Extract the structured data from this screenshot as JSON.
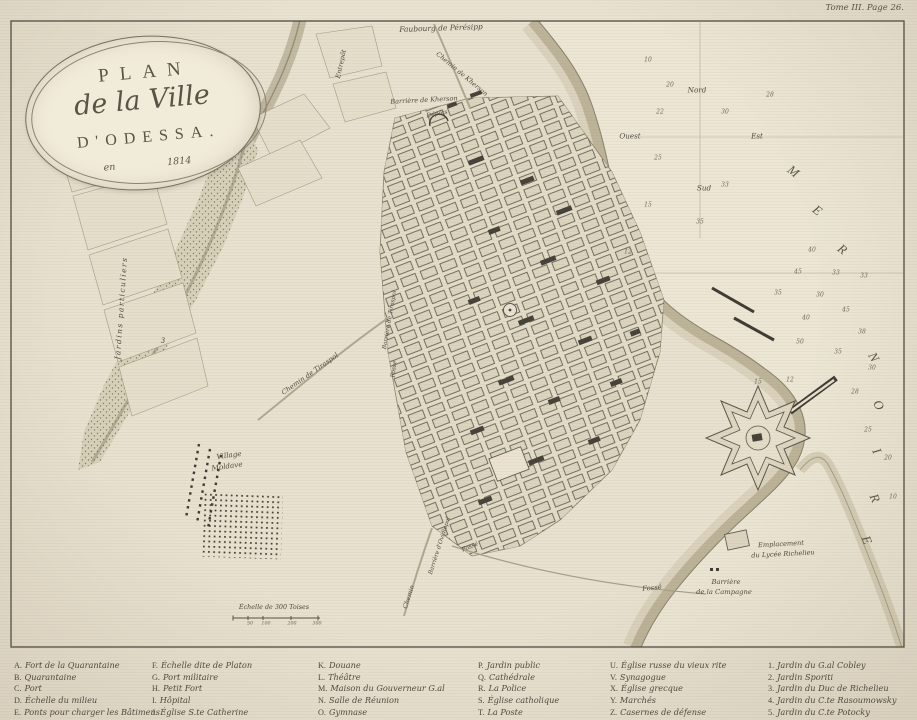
{
  "page": {
    "corner_note": "Tome III. Page 26."
  },
  "cartouche": {
    "top": "PLAN",
    "middle": "de la Ville",
    "bottom": "D'ODESSA.",
    "year_left": "en",
    "year_right": "1814"
  },
  "colors": {
    "paper": "#e9e2d1",
    "ink": "#4f4b40",
    "sea": "#ece6d5"
  },
  "legend": {
    "col_x": [
      14,
      152,
      318,
      478,
      610,
      768
    ],
    "columns": [
      [
        {
          "k": "A.",
          "t": "Fort de la Quarantaine"
        },
        {
          "k": "B.",
          "t": "Quarantaine"
        },
        {
          "k": "C.",
          "t": "Port"
        },
        {
          "k": "D.",
          "t": "Échelle du milieu"
        },
        {
          "k": "E.",
          "t": "Ponts pour charger les Bâtimens"
        }
      ],
      [
        {
          "k": "F.",
          "t": "Échelle dite de Platon"
        },
        {
          "k": "G.",
          "t": "Port militaire"
        },
        {
          "k": "H.",
          "t": "Petit Fort"
        },
        {
          "k": "I.",
          "t": "Hôpital"
        },
        {
          "k": "J.",
          "t": "Église S.te Catherine"
        }
      ],
      [
        {
          "k": "K.",
          "t": "Douane"
        },
        {
          "k": "L.",
          "t": "Théâtre"
        },
        {
          "k": "M.",
          "t": "Maison du Gouverneur G.al"
        },
        {
          "k": "N.",
          "t": "Salle de Réunion"
        },
        {
          "k": "O.",
          "t": "Gymnase"
        }
      ],
      [
        {
          "k": "P.",
          "t": "Jardin public"
        },
        {
          "k": "Q.",
          "t": "Cathédrale"
        },
        {
          "k": "R.",
          "t": "La Police"
        },
        {
          "k": "S.",
          "t": "Église catholique"
        },
        {
          "k": "T.",
          "t": "La Poste"
        }
      ],
      [
        {
          "k": "U.",
          "t": "Église russe du vieux rite"
        },
        {
          "k": "V.",
          "t": "Synagogue"
        },
        {
          "k": "X.",
          "t": "Église grecque"
        },
        {
          "k": "Y.",
          "t": "Marchés"
        },
        {
          "k": "Z.",
          "t": "Casernes de défense"
        }
      ],
      [
        {
          "k": "1.",
          "t": "Jardin du G.al Cobley"
        },
        {
          "k": "2.",
          "t": "Jardin Sporiti"
        },
        {
          "k": "3.",
          "t": "Jardin du Duc de Richelieu"
        },
        {
          "k": "4.",
          "t": "Jardin du C.te Rasoumowsky"
        },
        {
          "k": "5.",
          "t": "Jardin du C.te Potocky"
        }
      ]
    ]
  },
  "map_labels": [
    {
      "t": "Faubourg de Pérésipp",
      "x": 441,
      "y": 28,
      "r": -2,
      "s": 7.5,
      "name": "label-faubourg-peresipp"
    },
    {
      "t": "Chemin de Kherson",
      "x": 462,
      "y": 74,
      "r": 40,
      "s": 6.5,
      "name": "label-chemin-de-kherson"
    },
    {
      "t": "Barrière de Kherson",
      "x": 424,
      "y": 100,
      "r": -3,
      "s": 6.5,
      "name": "label-barriere-de-kherson"
    },
    {
      "t": "Dépôts",
      "x": 437,
      "y": 114,
      "r": -10,
      "s": 6,
      "name": "label-depots"
    },
    {
      "t": "Entrepôt",
      "x": 341,
      "y": 64,
      "r": -78,
      "s": 6.5,
      "name": "label-entrepot"
    },
    {
      "t": "Jardins particuliers",
      "x": 121,
      "y": 308,
      "r": -86,
      "s": 7.5,
      "ls": 1.5,
      "name": "label-jardins-particuliers"
    },
    {
      "t": "3",
      "x": 163,
      "y": 341,
      "r": 0,
      "s": 7,
      "name": "label-garden-3"
    },
    {
      "t": "Chemin de Tiraspol",
      "x": 310,
      "y": 374,
      "r": -35,
      "s": 6.8,
      "name": "label-chemin-de-tiraspol"
    },
    {
      "t": "Barrière de Tiraspol",
      "x": 390,
      "y": 320,
      "r": -80,
      "s": 5.8,
      "name": "label-barriere-de-tiraspol"
    },
    {
      "t": "Fossé",
      "x": 394,
      "y": 369,
      "r": -84,
      "s": 6,
      "name": "label-fosse-west"
    },
    {
      "t": "Village",
      "x": 229,
      "y": 455,
      "r": -8,
      "s": 7.2,
      "name": "label-village"
    },
    {
      "t": "Moldave",
      "x": 227,
      "y": 466,
      "r": -8,
      "s": 7.2,
      "name": "label-moldave"
    },
    {
      "t": "Barrière d'Ovidiopol",
      "x": 440,
      "y": 546,
      "r": -72,
      "s": 5.8,
      "name": "label-barriere-ovidiopol"
    },
    {
      "t": "Chemin",
      "x": 409,
      "y": 597,
      "r": -72,
      "s": 6.2,
      "name": "label-chemin-ovidiopol"
    },
    {
      "t": "Fossé",
      "x": 470,
      "y": 547,
      "r": -22,
      "s": 6,
      "name": "label-fosse-south"
    },
    {
      "t": "Fossé",
      "x": 652,
      "y": 588,
      "r": -6,
      "s": 6.8,
      "name": "label-fosse-east"
    },
    {
      "t": "Barrière",
      "x": 726,
      "y": 582,
      "r": 0,
      "s": 6.8,
      "name": "label-barriere-campagne-line1"
    },
    {
      "t": "de la Campagne",
      "x": 724,
      "y": 592,
      "r": 0,
      "s": 6.8,
      "name": "label-barriere-campagne-line2"
    },
    {
      "t": "Emplacement",
      "x": 781,
      "y": 544,
      "r": -3,
      "s": 6.6,
      "name": "label-emplacement"
    },
    {
      "t": "du Lycée Richelieu",
      "x": 783,
      "y": 554,
      "r": -3,
      "s": 6.6,
      "name": "label-lycee-richelieu"
    },
    {
      "t": "Échelle de 300 Toises",
      "x": 274,
      "y": 607,
      "r": 0,
      "s": 6.4,
      "name": "label-scale-bar"
    },
    {
      "t": "50",
      "x": 250,
      "y": 624,
      "r": 0,
      "s": 4.8,
      "cls": "snd",
      "name": "scale-tick"
    },
    {
      "t": "100",
      "x": 266,
      "y": 624,
      "r": 0,
      "s": 4.8,
      "cls": "snd",
      "name": "scale-tick"
    },
    {
      "t": "200",
      "x": 292,
      "y": 624,
      "r": 0,
      "s": 4.8,
      "cls": "snd",
      "name": "scale-tick"
    },
    {
      "t": "300",
      "x": 317,
      "y": 624,
      "r": 0,
      "s": 4.8,
      "cls": "snd",
      "name": "scale-tick"
    },
    {
      "t": "Nord",
      "x": 697,
      "y": 90,
      "r": 0,
      "s": 7.2,
      "name": "compass-north"
    },
    {
      "t": "Ouest",
      "x": 630,
      "y": 136,
      "r": 0,
      "s": 7.2,
      "name": "compass-west"
    },
    {
      "t": "Est",
      "x": 757,
      "y": 136,
      "r": 0,
      "s": 7.2,
      "name": "compass-east"
    },
    {
      "t": "Sud",
      "x": 704,
      "y": 188,
      "r": 0,
      "s": 7.2,
      "name": "compass-south"
    },
    {
      "t": "M",
      "x": 794,
      "y": 172,
      "r": 38,
      "s": 13,
      "cls": "sea",
      "name": "sea-name-letter"
    },
    {
      "t": "E",
      "x": 818,
      "y": 211,
      "r": 38,
      "s": 13,
      "cls": "sea",
      "name": "sea-name-letter"
    },
    {
      "t": "R",
      "x": 843,
      "y": 250,
      "r": 38,
      "s": 13,
      "cls": "sea",
      "name": "sea-name-letter"
    },
    {
      "t": "N",
      "x": 874,
      "y": 358,
      "r": 60,
      "s": 13,
      "cls": "sea",
      "name": "sea-name-letter"
    },
    {
      "t": "O",
      "x": 879,
      "y": 406,
      "r": 62,
      "s": 13,
      "cls": "sea",
      "name": "sea-name-letter"
    },
    {
      "t": "I",
      "x": 877,
      "y": 452,
      "r": 64,
      "s": 13,
      "cls": "sea",
      "name": "sea-name-letter"
    },
    {
      "t": "R",
      "x": 875,
      "y": 499,
      "r": 66,
      "s": 13,
      "cls": "sea",
      "name": "sea-name-letter"
    },
    {
      "t": "E",
      "x": 867,
      "y": 541,
      "r": 68,
      "s": 13,
      "cls": "sea",
      "name": "sea-name-letter"
    },
    {
      "t": "10",
      "x": 648,
      "y": 60,
      "s": 6,
      "cls": "snd",
      "name": "depth-sounding"
    },
    {
      "t": "20",
      "x": 670,
      "y": 85,
      "s": 6,
      "cls": "snd",
      "name": "depth-sounding"
    },
    {
      "t": "22",
      "x": 660,
      "y": 112,
      "s": 6,
      "cls": "snd",
      "name": "depth-sounding"
    },
    {
      "t": "25",
      "x": 658,
      "y": 158,
      "s": 6,
      "cls": "snd",
      "name": "depth-sounding"
    },
    {
      "t": "30",
      "x": 725,
      "y": 112,
      "s": 6,
      "cls": "snd",
      "name": "depth-sounding"
    },
    {
      "t": "28",
      "x": 770,
      "y": 95,
      "s": 6,
      "cls": "snd",
      "name": "depth-sounding"
    },
    {
      "t": "33",
      "x": 725,
      "y": 185,
      "s": 6,
      "cls": "snd",
      "name": "depth-sounding"
    },
    {
      "t": "35",
      "x": 700,
      "y": 222,
      "s": 6,
      "cls": "snd",
      "name": "depth-sounding"
    },
    {
      "t": "15",
      "x": 648,
      "y": 205,
      "s": 6,
      "cls": "snd",
      "name": "depth-sounding"
    },
    {
      "t": "12",
      "x": 628,
      "y": 252,
      "s": 6,
      "cls": "snd",
      "name": "depth-sounding"
    },
    {
      "t": "40",
      "x": 812,
      "y": 250,
      "s": 6,
      "cls": "snd",
      "name": "depth-sounding"
    },
    {
      "t": "45",
      "x": 798,
      "y": 272,
      "s": 6,
      "cls": "snd",
      "name": "depth-sounding"
    },
    {
      "t": "33",
      "x": 836,
      "y": 273,
      "s": 6,
      "cls": "snd",
      "name": "depth-sounding"
    },
    {
      "t": "33",
      "x": 864,
      "y": 276,
      "s": 6,
      "cls": "snd",
      "name": "depth-sounding"
    },
    {
      "t": "35",
      "x": 778,
      "y": 293,
      "s": 6,
      "cls": "snd",
      "name": "depth-sounding"
    },
    {
      "t": "30",
      "x": 820,
      "y": 295,
      "s": 6,
      "cls": "snd",
      "name": "depth-sounding"
    },
    {
      "t": "45",
      "x": 846,
      "y": 310,
      "s": 6,
      "cls": "snd",
      "name": "depth-sounding"
    },
    {
      "t": "40",
      "x": 806,
      "y": 318,
      "s": 6,
      "cls": "snd",
      "name": "depth-sounding"
    },
    {
      "t": "38",
      "x": 862,
      "y": 332,
      "s": 6,
      "cls": "snd",
      "name": "depth-sounding"
    },
    {
      "t": "50",
      "x": 800,
      "y": 342,
      "s": 6,
      "cls": "snd",
      "name": "depth-sounding"
    },
    {
      "t": "35",
      "x": 838,
      "y": 352,
      "s": 6,
      "cls": "snd",
      "name": "depth-sounding"
    },
    {
      "t": "30",
      "x": 872,
      "y": 368,
      "s": 6,
      "cls": "snd",
      "name": "depth-sounding"
    },
    {
      "t": "15",
      "x": 758,
      "y": 382,
      "s": 6,
      "cls": "snd",
      "name": "depth-sounding"
    },
    {
      "t": "12",
      "x": 790,
      "y": 380,
      "s": 6,
      "cls": "snd",
      "name": "depth-sounding"
    },
    {
      "t": "28",
      "x": 855,
      "y": 392,
      "s": 6,
      "cls": "snd",
      "name": "depth-sounding"
    },
    {
      "t": "25",
      "x": 868,
      "y": 430,
      "s": 6,
      "cls": "snd",
      "name": "depth-sounding"
    },
    {
      "t": "20",
      "x": 888,
      "y": 458,
      "s": 6,
      "cls": "snd",
      "name": "depth-sounding"
    },
    {
      "t": "10",
      "x": 893,
      "y": 497,
      "s": 6,
      "cls": "snd",
      "name": "depth-sounding"
    }
  ]
}
